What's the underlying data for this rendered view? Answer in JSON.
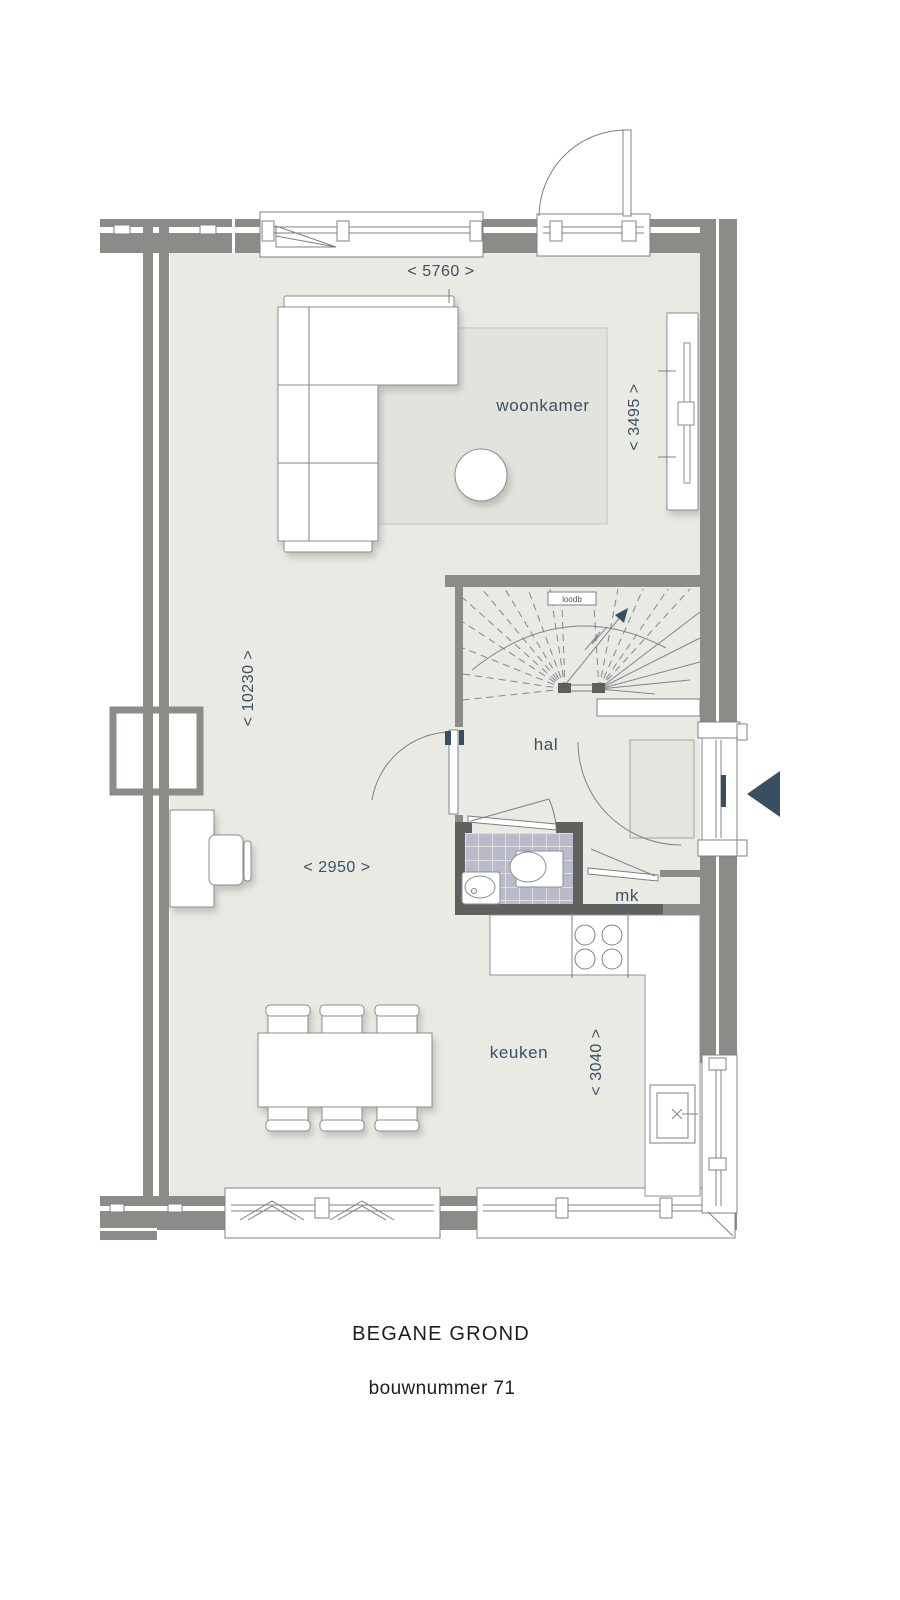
{
  "document": {
    "floor_title": "BEGANE GROND",
    "unit_title": "bouwnummer 71"
  },
  "rooms": {
    "living_room": "woonkamer",
    "hallway": "hal",
    "kitchen": "keuken",
    "meter_cupboard": "mk"
  },
  "annotations": {
    "stair_note": "loodb"
  },
  "dimensions": {
    "living_width_mm": "< 5760 >",
    "living_depth_mm": "< 3495 >",
    "house_length_mm": "< 10230 >",
    "living_mid_width_mm": "< 2950 >",
    "kitchen_depth_mm": "< 3040 >"
  },
  "colors": {
    "wall": "#8a8c88",
    "inner_wall_dark": "#5e615e",
    "floor": "#e9eae3",
    "rug": "#e2e3dc",
    "tile": "#b9bcc8",
    "accent_navy": "#3a4e61",
    "line": "#7d8084"
  }
}
